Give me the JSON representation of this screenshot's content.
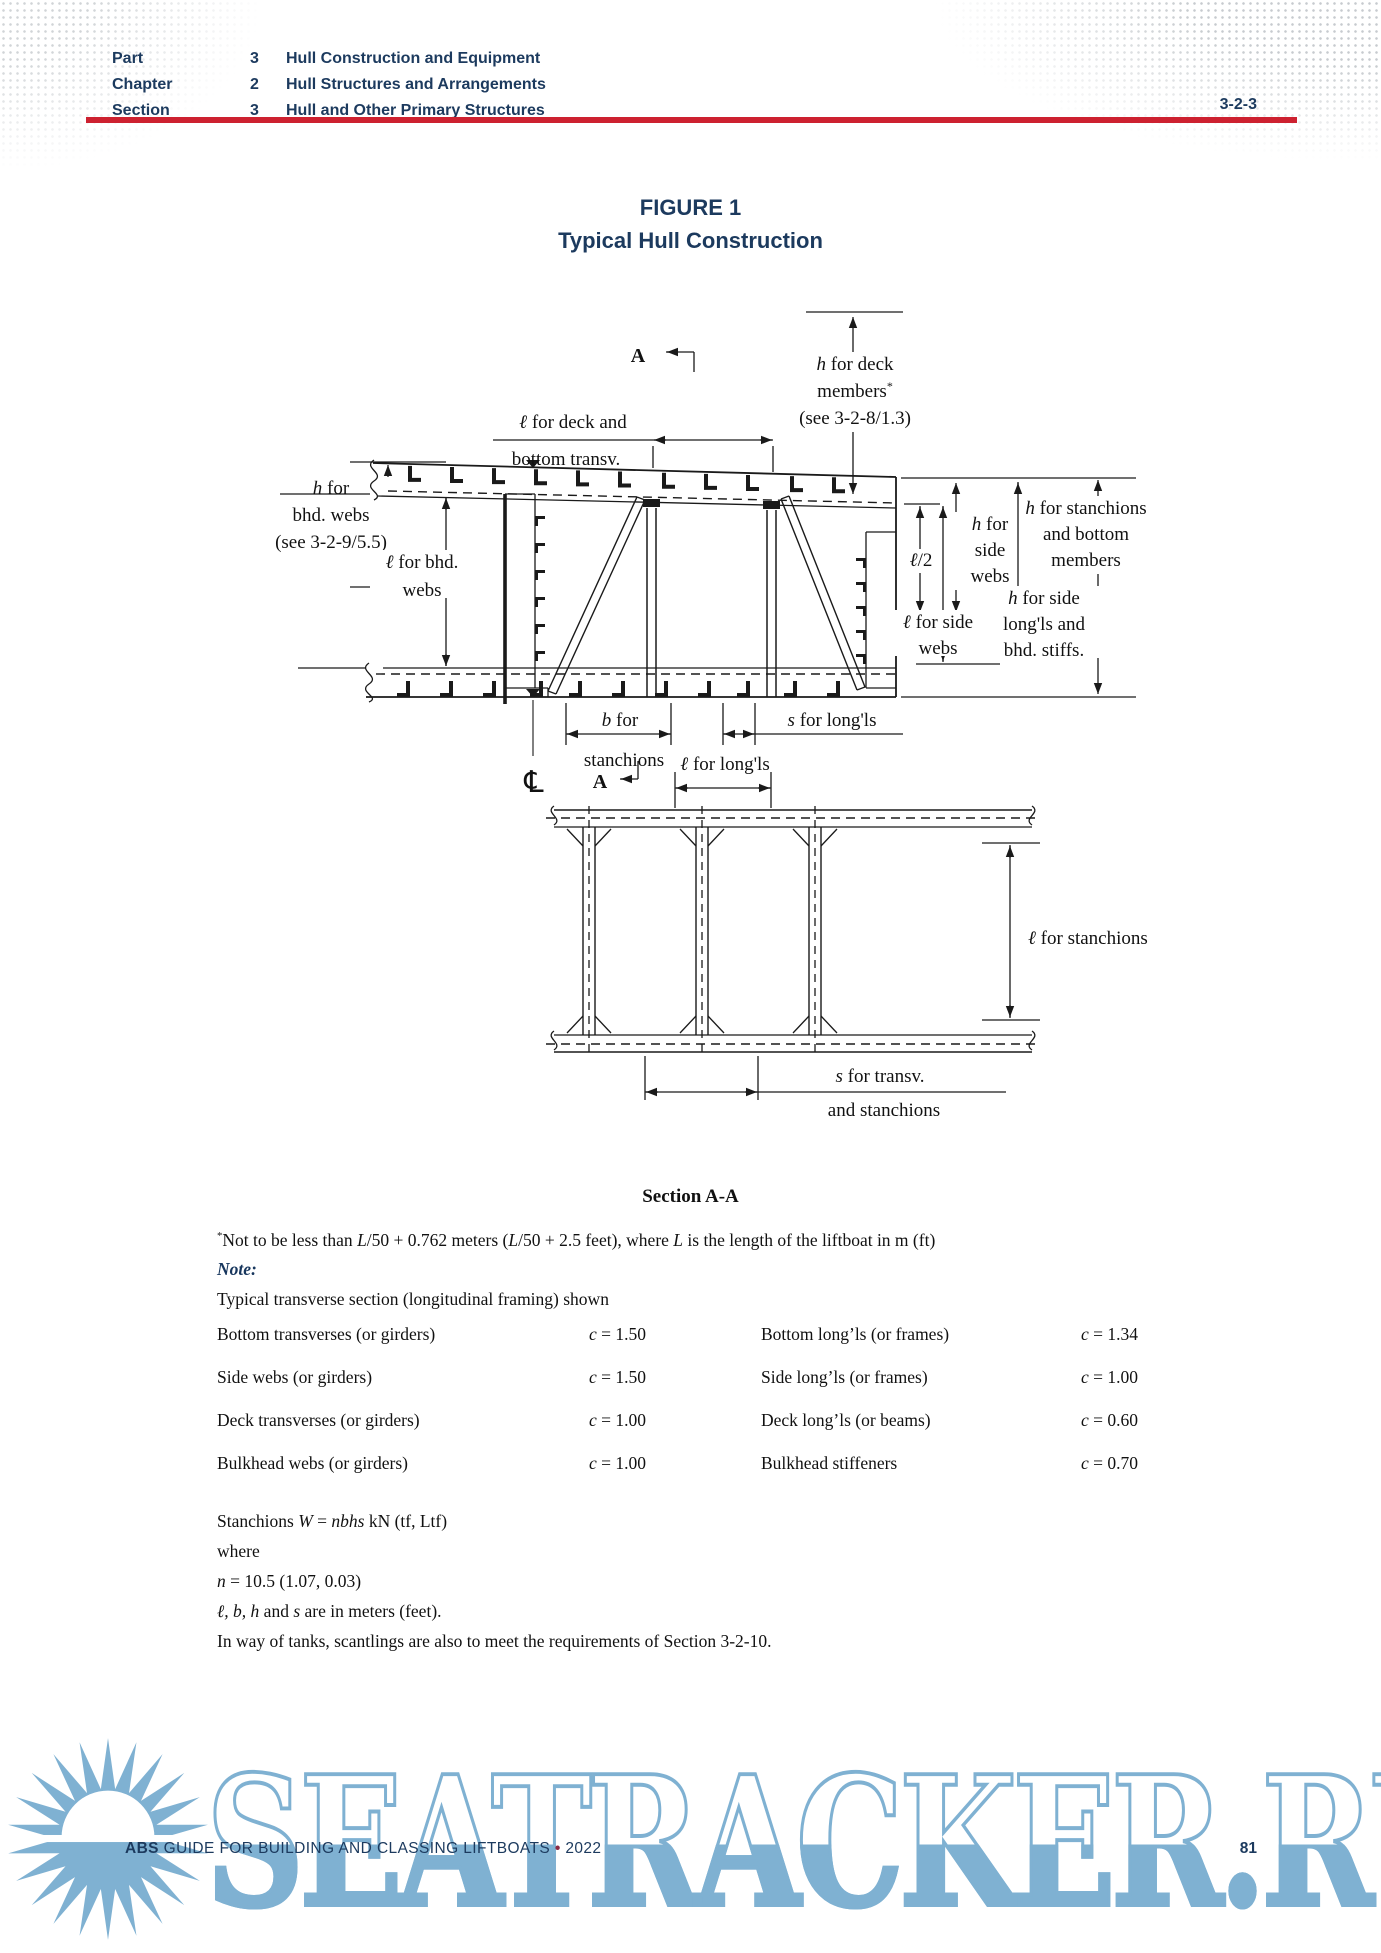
{
  "header": {
    "rows": [
      {
        "label": "Part",
        "num": "3",
        "title": "Hull Construction and Equipment"
      },
      {
        "label": "Chapter",
        "num": "2",
        "title": "Hull Structures and Arrangements"
      },
      {
        "label": "Section",
        "num": "3",
        "title": "Hull and Other Primary Structures"
      }
    ],
    "section_code": "3-2-3"
  },
  "figure": {
    "title_line1": "FIGURE 1",
    "title_line2": "Typical Hull Construction",
    "caption": "Section A-A",
    "centerline_symbol": "℄",
    "labels": [
      {
        "name": "section-arrow-a-top",
        "x": 640,
        "y": 362,
        "size": 20,
        "lines": [
          [
            {
              "t": "A",
              "b": 1
            }
          ]
        ]
      },
      {
        "name": "h-deck-members",
        "x": 857,
        "y": 370,
        "lines": [
          [
            {
              "t": "h",
              "i": 1
            },
            {
              "t": " for deck"
            }
          ],
          [
            {
              "t": "members"
            },
            {
              "t": "*",
              "sup": 1
            }
          ],
          [
            {
              "t": "(see 3-2-8/1.3)"
            }
          ]
        ]
      },
      {
        "name": "l-deck-bottom-transv-1",
        "x": 575,
        "y": 428,
        "lines": [
          [
            {
              "t": "ℓ",
              "i": 1
            },
            {
              "t": " for deck and"
            }
          ]
        ]
      },
      {
        "name": "l-deck-bottom-transv-2",
        "x": 568,
        "y": 465,
        "lines": [
          [
            {
              "t": "bottom transv."
            }
          ]
        ]
      },
      {
        "name": "h-bhd-webs",
        "x": 333,
        "y": 494,
        "lines": [
          [
            {
              "t": "h",
              "i": 1
            },
            {
              "t": " for"
            }
          ],
          [
            {
              "t": "bhd. webs"
            }
          ],
          [
            {
              "t": "(see 3-2-9/5.5)"
            }
          ]
        ]
      },
      {
        "name": "l-bhd-webs",
        "x": 424,
        "y": 568,
        "lh": 28,
        "bg": [
          372,
          550,
          104,
          48
        ],
        "lines": [
          [
            {
              "t": "ℓ",
              "i": 1
            },
            {
              "t": " for bhd."
            }
          ],
          [
            {
              "t": "webs"
            }
          ]
        ]
      },
      {
        "name": "h-side-webs",
        "x": 992,
        "y": 530,
        "lh": 26,
        "lines": [
          [
            {
              "t": "h",
              "i": 1
            },
            {
              "t": " for"
            }
          ],
          [
            {
              "t": "side"
            }
          ],
          [
            {
              "t": "webs"
            }
          ]
        ]
      },
      {
        "name": "l-over-2",
        "x": 923,
        "y": 566,
        "bg": [
          904,
          549,
          40,
          24
        ],
        "lines": [
          [
            {
              "t": "ℓ",
              "i": 1
            },
            {
              "t": "/2"
            }
          ]
        ]
      },
      {
        "name": "l-side-webs",
        "x": 940,
        "y": 628,
        "lh": 26,
        "bg": [
          892,
          610,
          98,
          46
        ],
        "lines": [
          [
            {
              "t": "ℓ",
              "i": 1
            },
            {
              "t": " for side"
            }
          ],
          [
            {
              "t": "webs"
            }
          ]
        ]
      },
      {
        "name": "h-side-longls",
        "x": 1046,
        "y": 604,
        "lh": 26,
        "bg": [
          990,
          586,
          114,
          72
        ],
        "lines": [
          [
            {
              "t": "h",
              "i": 1
            },
            {
              "t": " for side"
            }
          ],
          [
            {
              "t": "long'ls and"
            }
          ],
          [
            {
              "t": "bhd. stiffs."
            }
          ]
        ]
      },
      {
        "name": "h-stanchions-bottom",
        "x": 1088,
        "y": 514,
        "lh": 26,
        "lines": [
          [
            {
              "t": "h",
              "i": 1
            },
            {
              "t": " for stanchions"
            }
          ],
          [
            {
              "t": "and bottom"
            }
          ],
          [
            {
              "t": "members"
            }
          ]
        ]
      },
      {
        "name": "b-for-stanchions-1",
        "x": 622,
        "y": 726,
        "lines": [
          [
            {
              "t": "b",
              "i": 1
            },
            {
              "t": " for"
            }
          ]
        ]
      },
      {
        "name": "b-for-stanchions-2",
        "x": 626,
        "y": 766,
        "lines": [
          [
            {
              "t": "stanchions"
            }
          ]
        ]
      },
      {
        "name": "s-for-longls",
        "x": 834,
        "y": 726,
        "lines": [
          [
            {
              "t": "s",
              "i": 1
            },
            {
              "t": " for long'ls"
            }
          ]
        ]
      },
      {
        "name": "centerline-symbol",
        "x": 536,
        "y": 792,
        "size": 30,
        "f": "DejaVu Sans",
        "lines": [
          [
            {
              "t": "℄"
            }
          ]
        ]
      },
      {
        "name": "section-arrow-a-bottom",
        "x": 602,
        "y": 788,
        "size": 20,
        "lines": [
          [
            {
              "t": "A",
              "b": 1
            }
          ]
        ]
      },
      {
        "name": "l-for-longls",
        "x": 727,
        "y": 770,
        "lines": [
          [
            {
              "t": "ℓ",
              "i": 1
            },
            {
              "t": " for long'ls"
            }
          ]
        ]
      },
      {
        "name": "l-for-stanchions",
        "x": 1030,
        "y": 944,
        "anchor": "start",
        "lines": [
          [
            {
              "t": "ℓ",
              "i": 1
            },
            {
              "t": " for stanchions"
            }
          ]
        ]
      },
      {
        "name": "s-for-transv-1",
        "x": 882,
        "y": 1082,
        "lines": [
          [
            {
              "t": "s",
              "i": 1
            },
            {
              "t": " for transv."
            }
          ]
        ]
      },
      {
        "name": "s-for-transv-2",
        "x": 886,
        "y": 1116,
        "lines": [
          [
            {
              "t": "and stanchions"
            }
          ]
        ]
      }
    ]
  },
  "notes": {
    "footnote_parts": [
      {
        "t": "*",
        "sup": 1
      },
      {
        "t": "Not to be less than "
      },
      {
        "t": "L",
        "i": 1
      },
      {
        "t": "/50 + 0.762 meters ("
      },
      {
        "t": "L",
        "i": 1
      },
      {
        "t": "/50 + 2.5 feet), where "
      },
      {
        "t": "L",
        "i": 1
      },
      {
        "t": " is the length of the liftboat in m (ft)"
      }
    ],
    "note_line_parts": [
      {
        "t": "Note:",
        "i": 1,
        "b": 1,
        "color": "#17365d"
      }
    ],
    "typical": "Typical transverse section (longitudinal framing) shown"
  },
  "coefficients": {
    "rows": [
      {
        "left_label": "Bottom transverses (or girders)",
        "left_value_parts": [
          {
            "t": "c",
            "i": 1
          },
          {
            "t": " = 1.50"
          }
        ],
        "right_label": "Bottom long’ls (or frames)",
        "right_value_parts": [
          {
            "t": "c",
            "i": 1
          },
          {
            "t": " = 1.34"
          }
        ]
      },
      {
        "left_label": "Side webs (or girders)",
        "left_value_parts": [
          {
            "t": "c",
            "i": 1
          },
          {
            "t": " = 1.50"
          }
        ],
        "right_label": "Side long’ls (or frames)",
        "right_value_parts": [
          {
            "t": "c",
            "i": 1
          },
          {
            "t": " = 1.00"
          }
        ]
      },
      {
        "left_label": "Deck transverses (or girders)",
        "left_value_parts": [
          {
            "t": "c",
            "i": 1
          },
          {
            "t": " = 1.00"
          }
        ],
        "right_label": "Deck long’ls (or beams)",
        "right_value_parts": [
          {
            "t": "c",
            "i": 1
          },
          {
            "t": " = 0.60"
          }
        ]
      },
      {
        "left_label": "Bulkhead webs (or girders)",
        "left_value_parts": [
          {
            "t": "c",
            "i": 1
          },
          {
            "t": " = 1.00"
          }
        ],
        "right_label": "Bulkhead stiffeners",
        "right_value_parts": [
          {
            "t": "c",
            "i": 1
          },
          {
            "t": " = 0.70"
          }
        ]
      }
    ]
  },
  "stanchions_block": {
    "lines": [
      [
        {
          "t": "Stanchions "
        },
        {
          "t": "W",
          "i": 1
        },
        {
          "t": " = "
        },
        {
          "t": "nbhs",
          "i": 1
        },
        {
          "t": " kN (tf, Ltf)"
        }
      ],
      [
        {
          "t": "where"
        }
      ],
      [
        {
          "t": "n",
          "i": 1
        },
        {
          "t": " = 10.5 (1.07, 0.03)"
        }
      ],
      [
        {
          "t": "ℓ, b, h",
          "i": 1
        },
        {
          "t": " and "
        },
        {
          "t": "s",
          "i": 1
        },
        {
          "t": " are in meters (feet)."
        }
      ],
      [
        {
          "t": "In way of tanks, scantlings are also to meet the requirements of Section 3-2-10."
        }
      ]
    ]
  },
  "footer": {
    "brand": "ABS",
    "text": " GUIDE FOR BUILDING AND CLASSING LIFTBOATS ",
    "sep": "•",
    "year": " 2022",
    "page": "81"
  },
  "watermark": {
    "text": "SEATRACKER.RU",
    "color": "#7fb1d2"
  },
  "colors": {
    "accent_navy": "#1c3a5e",
    "rule_red": "#cd2130",
    "note_navy": "#17365d",
    "watermark_blue": "#7fb1d2",
    "footer_sep_maroon": "#8a2a44"
  }
}
